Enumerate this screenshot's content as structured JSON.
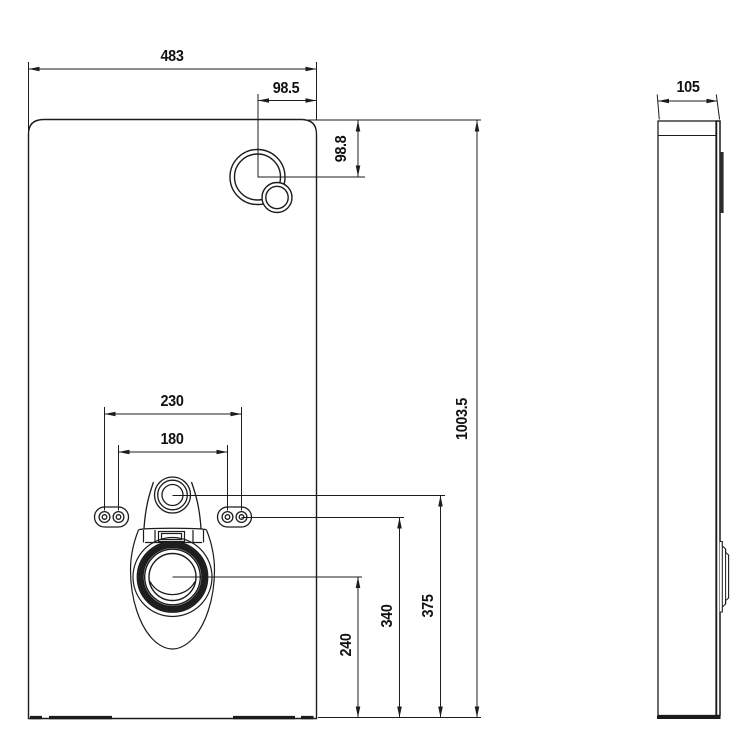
{
  "drawing": {
    "type": "technical-dimension-drawing",
    "subject": "sanitary module cistern panel, front and side elevation",
    "colors": {
      "line": "#1c1c1c",
      "background": "#ffffff"
    },
    "front_view": {
      "width": "483",
      "flush_button_offset_x": "98.5",
      "flush_button_offset_y": "98.8",
      "anchor_outer_spacing": "230",
      "anchor_inner_spacing": "180",
      "height": "1003.5",
      "inlet_height": "375",
      "anchor_height": "340",
      "drain_height": "240"
    },
    "side_view": {
      "depth": "105"
    }
  }
}
